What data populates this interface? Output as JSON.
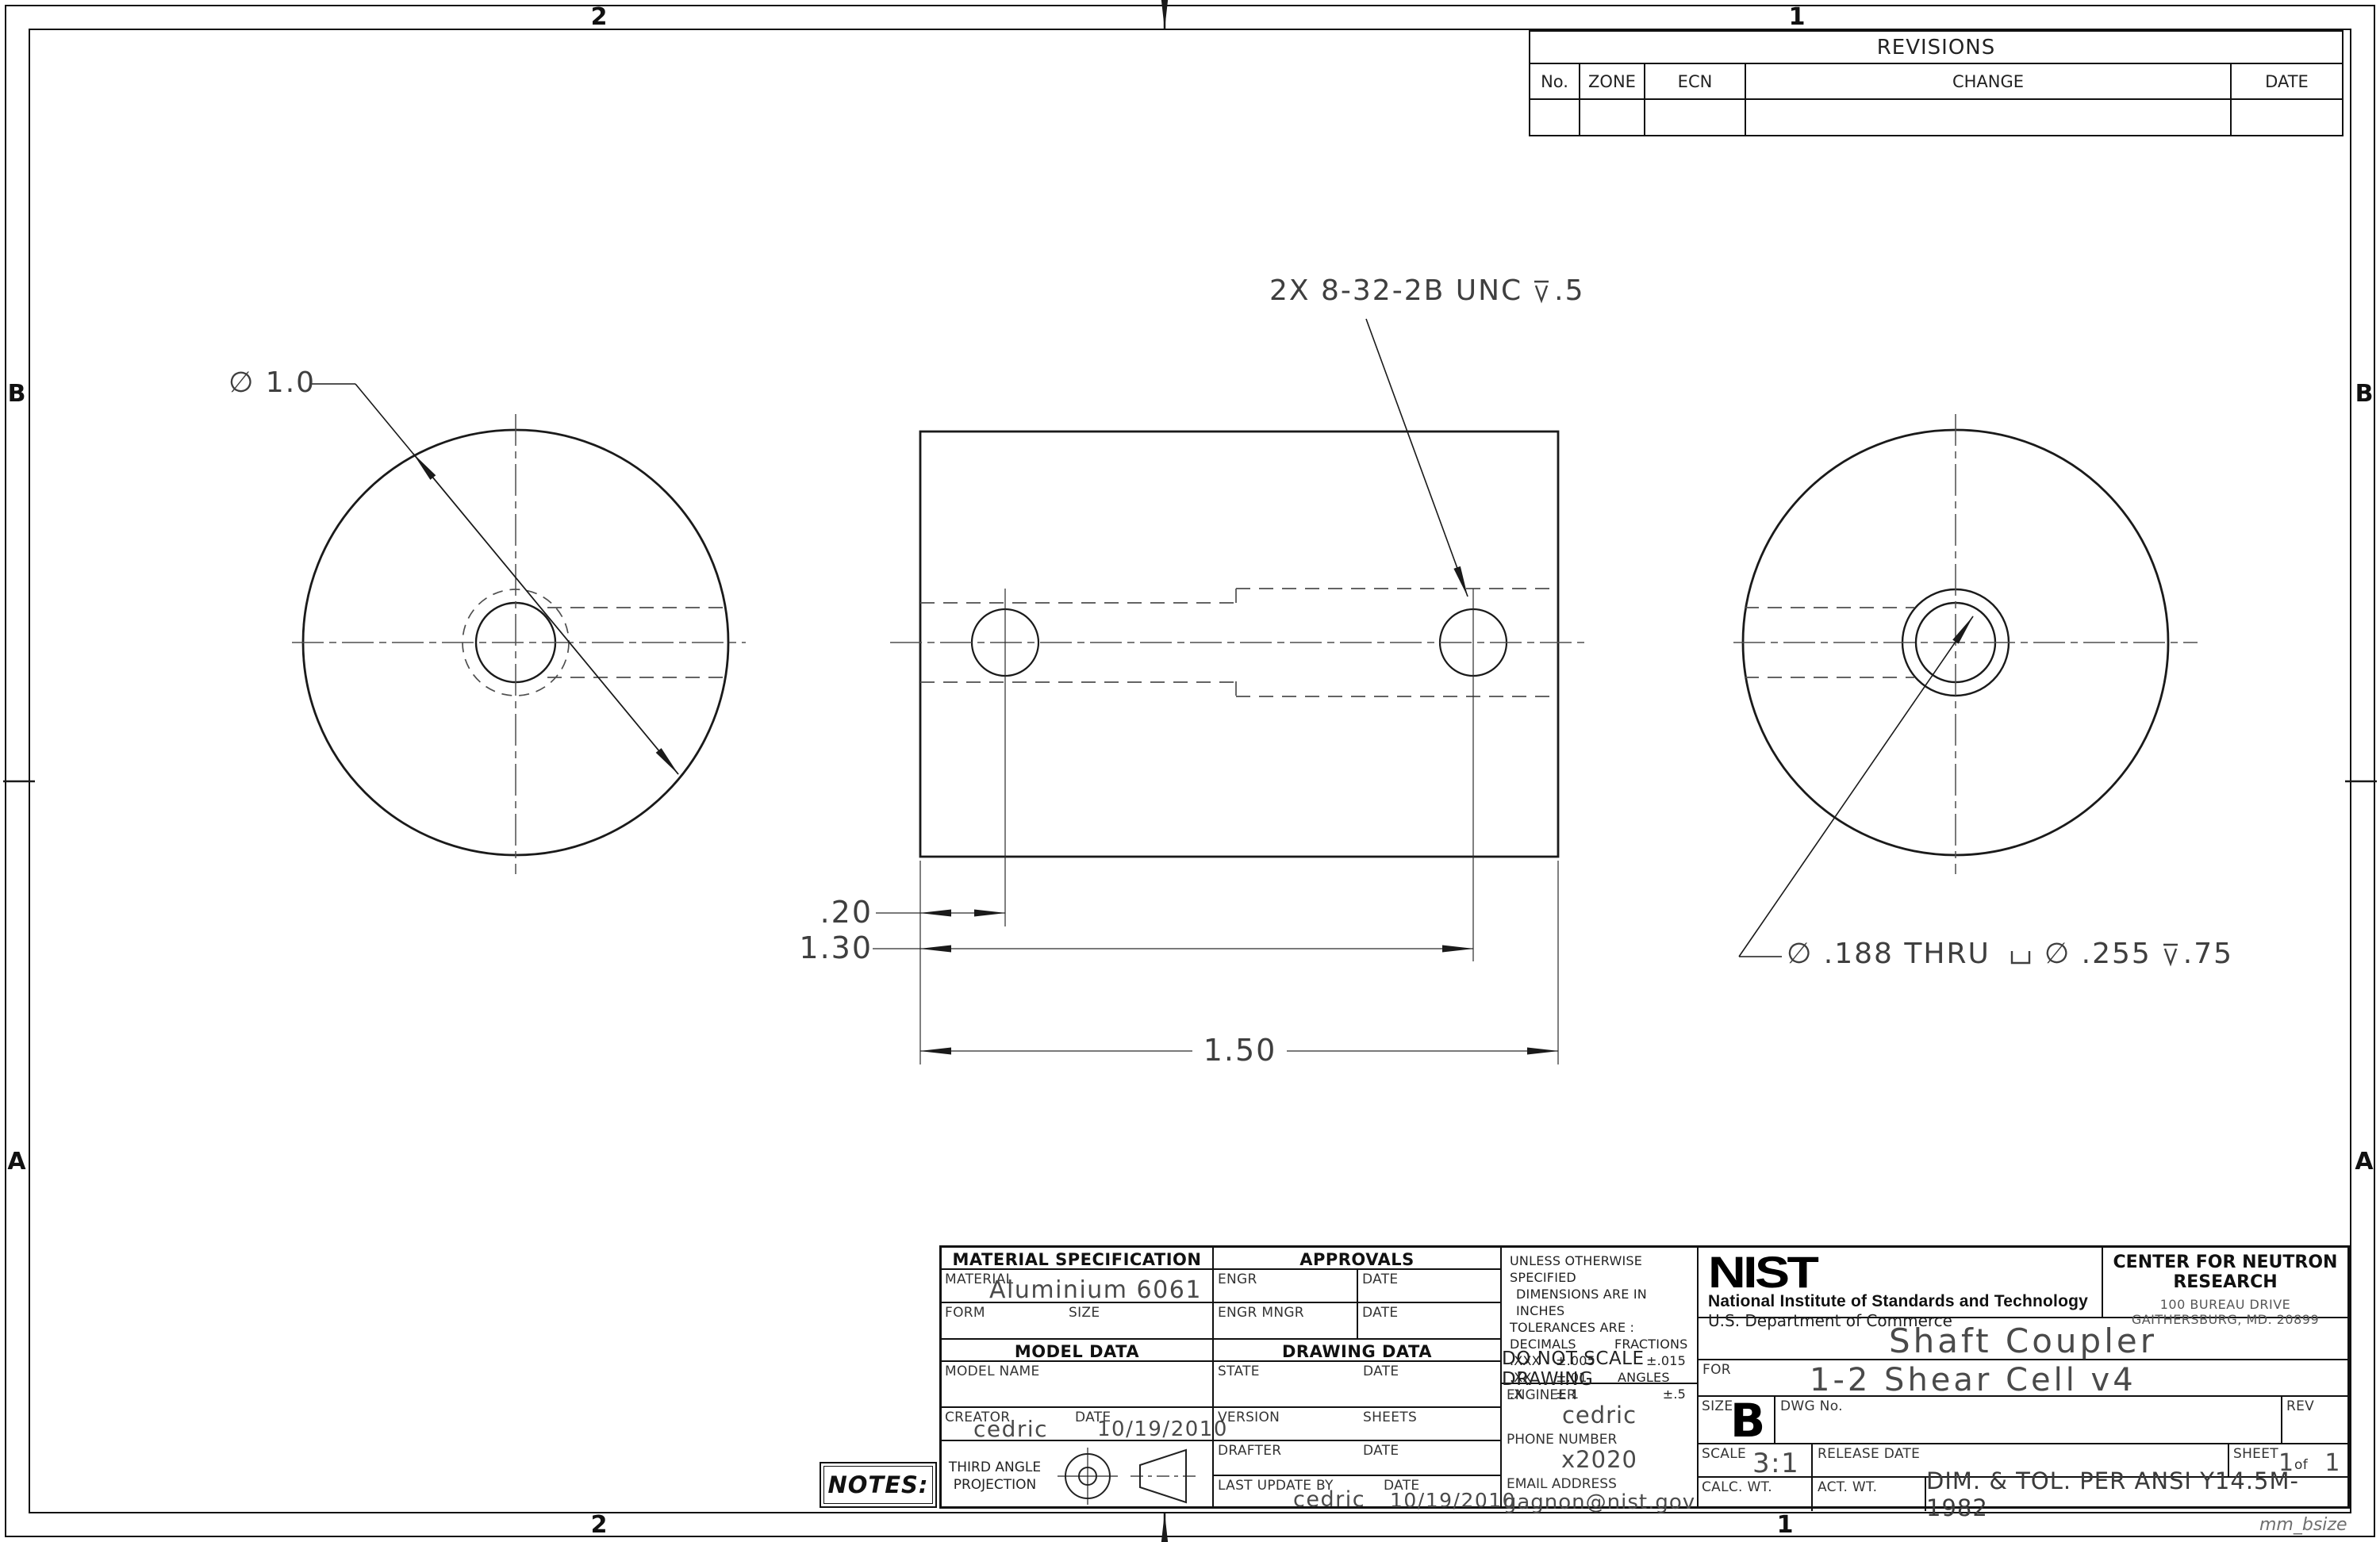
{
  "sheet": {
    "watermark": "mm_bsize",
    "zones": {
      "top_left": "2",
      "top_right": "1",
      "bottom_left": "2",
      "bottom_right": "1",
      "left_upper": "B",
      "left_lower": "A",
      "right_upper": "B",
      "right_lower": "A"
    }
  },
  "revisions": {
    "title": "REVISIONS",
    "col_no": "No.",
    "col_zone": "ZONE",
    "col_ecn": "ECN",
    "col_change": "CHANGE",
    "col_date": "DATE"
  },
  "callouts": {
    "od": "∅ 1.0",
    "tap": "2X  8-32-2B  UNC",
    "tap_depth": ".5",
    "hole_thru": "∅ .188  THRU",
    "cbore_dia": "∅ .255",
    "cbore_depth": ".75",
    "dim_short": ".20",
    "dim_mid": "1.30",
    "dim_full": "1.50",
    "depth_icon": "depth-symbol",
    "cbore_icon": "counterbore-symbol"
  },
  "title_block": {
    "material": {
      "header": "MATERIAL SPECIFICATION",
      "material_label": "MATERIAL",
      "material_value": "Aluminium 6061",
      "form_label": "FORM",
      "size_label": "SIZE",
      "model_header": "MODEL DATA",
      "model_name_label": "MODEL NAME",
      "creator_label": "CREATOR",
      "creator_value": "cedric",
      "date_label": "DATE",
      "creator_date_value": "10/19/2010",
      "projection_line1": "THIRD ANGLE",
      "projection_line2": "PROJECTION"
    },
    "approvals": {
      "header": "APPROVALS",
      "engr": "ENGR",
      "engr_mngr": "ENGR MNGR",
      "date": "DATE",
      "drawing_header": "DRAWING DATA",
      "state": "STATE",
      "version": "VERSION",
      "sheets": "SHEETS",
      "drafter": "DRAFTER",
      "last_update": "LAST UPDATE BY",
      "last_update_value": "cedric",
      "last_update_date": "10/19/2010"
    },
    "tolerances": {
      "l1": "UNLESS OTHERWISE SPECIFIED",
      "l2": "DIMENSIONS ARE IN INCHES",
      "l3": "TOLERANCES ARE :",
      "decimals": "DECIMALS",
      "fractions": "FRACTIONS",
      "r1a": ".XXX",
      "r1b": "±.005",
      "r1c": "±.015",
      "r2a": ".XX",
      "r2b": "±.01",
      "r2c": "ANGLES",
      "r3a": ".X",
      "r3b": "±.1",
      "r3c": "±.5",
      "do_not_scale": "DO NOT SCALE DRAWING"
    },
    "contact": {
      "engineer_label": "ENGINEER",
      "engineer": "cedric",
      "phone_label": "PHONE NUMBER",
      "phone": "x2020",
      "email_label": "EMAIL ADDRESS",
      "email": "gagnon@nist.gov"
    },
    "agency": {
      "logo": "NIST",
      "name": "National Institute of Standards and Technology",
      "dept": "U.S. Department of Commerce"
    },
    "facility": {
      "name": "CENTER FOR NEUTRON RESEARCH",
      "addr1": "100 BUREAU DRIVE",
      "addr2": "GAITHERSBURG, MD. 20899"
    },
    "drawing": {
      "title": "Shaft Coupler",
      "for_label": "FOR",
      "for_value": "1-2 Shear Cell v4",
      "size_label": "SIZE",
      "size": "B",
      "dwg_label": "DWG No.",
      "rev_label": "REV",
      "scale_label": "SCALE",
      "scale": "3:1",
      "release_label": "RELEASE DATE",
      "sheet_label": "SHEET",
      "sheet_no": "1",
      "sheet_of": "of",
      "sheet_total": "1",
      "calc_wt": "CALC. WT.",
      "act_wt": "ACT. WT.",
      "standard": "DIM. & TOL. PER ANSI Y14.5M-1982"
    }
  },
  "notes": "NOTES:"
}
